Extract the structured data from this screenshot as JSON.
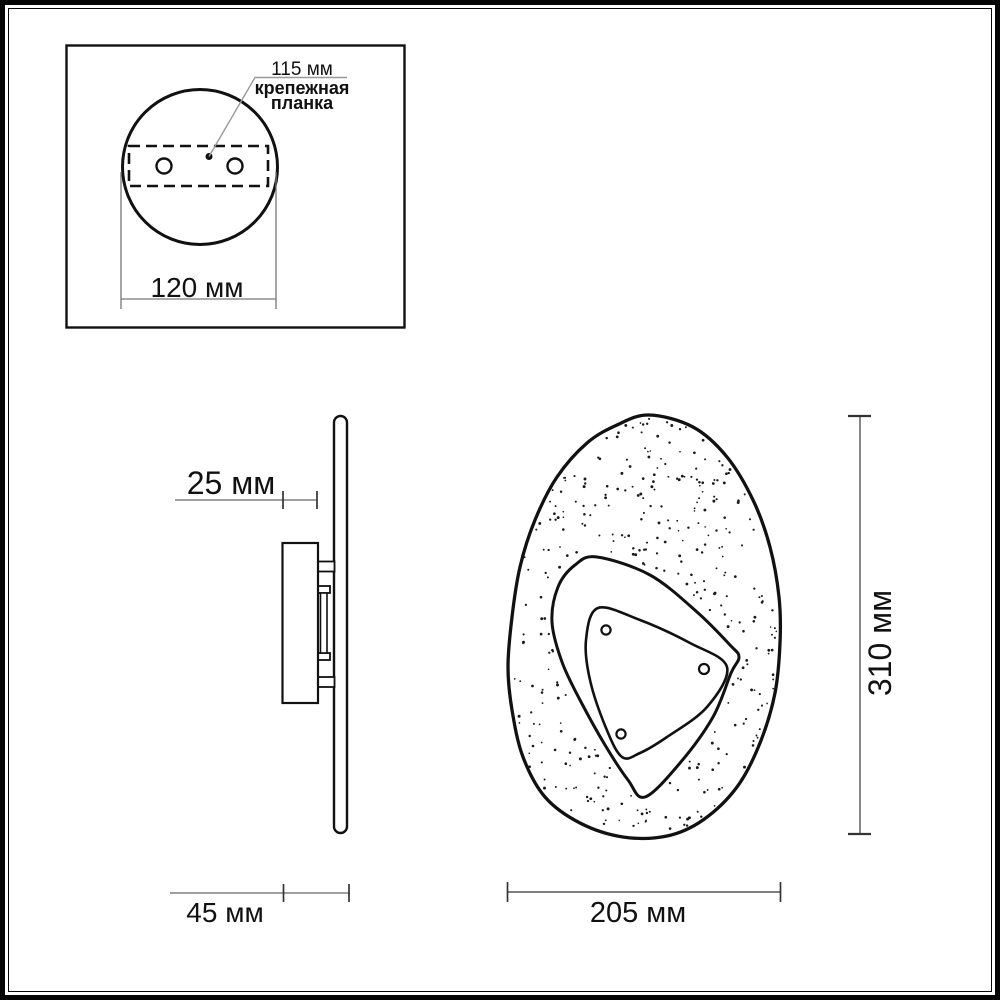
{
  "colors": {
    "ink": "#111111",
    "dim_line": "#777777",
    "tick": "#333333",
    "background": "#ffffff"
  },
  "inset_top_view": {
    "hole_spacing_label": "115 мм",
    "bracket_label_line1": "крепежная",
    "bracket_label_line2": "планка",
    "plate_width_label": "120 мм"
  },
  "side_view": {
    "plate_depth_label": "25 мм",
    "total_depth_label": "45 мм"
  },
  "front_view": {
    "height_label": "310 мм",
    "width_label": "205 мм"
  }
}
